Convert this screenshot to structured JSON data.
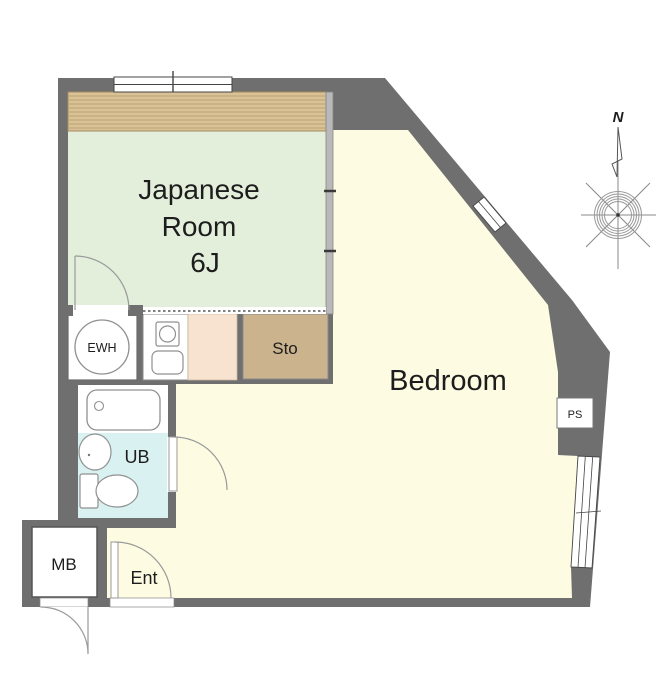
{
  "floorplan": {
    "rooms": {
      "japanese_room": {
        "line1": "Japanese",
        "line2": "Room",
        "line3": "6J"
      },
      "bedroom": {
        "label": "Bedroom"
      },
      "storage": {
        "label": "Sto"
      },
      "unit_bath": {
        "label": "UB"
      },
      "water_heater": {
        "label": "EWH"
      },
      "meter_box": {
        "label": "MB"
      },
      "entrance": {
        "label": "Ent"
      },
      "pipe_space": {
        "label": "PS"
      }
    },
    "compass": {
      "north_label": "N"
    },
    "colors": {
      "wall": "#6f6f6f",
      "japanese_room": "#e3efdb",
      "tatami_band": "#d9c296",
      "bedroom": "#fdfce3",
      "storage": "#cbb38d",
      "kitchen_counter": "#f7e3cf",
      "unit_bath": "#d9f2f1"
    }
  }
}
